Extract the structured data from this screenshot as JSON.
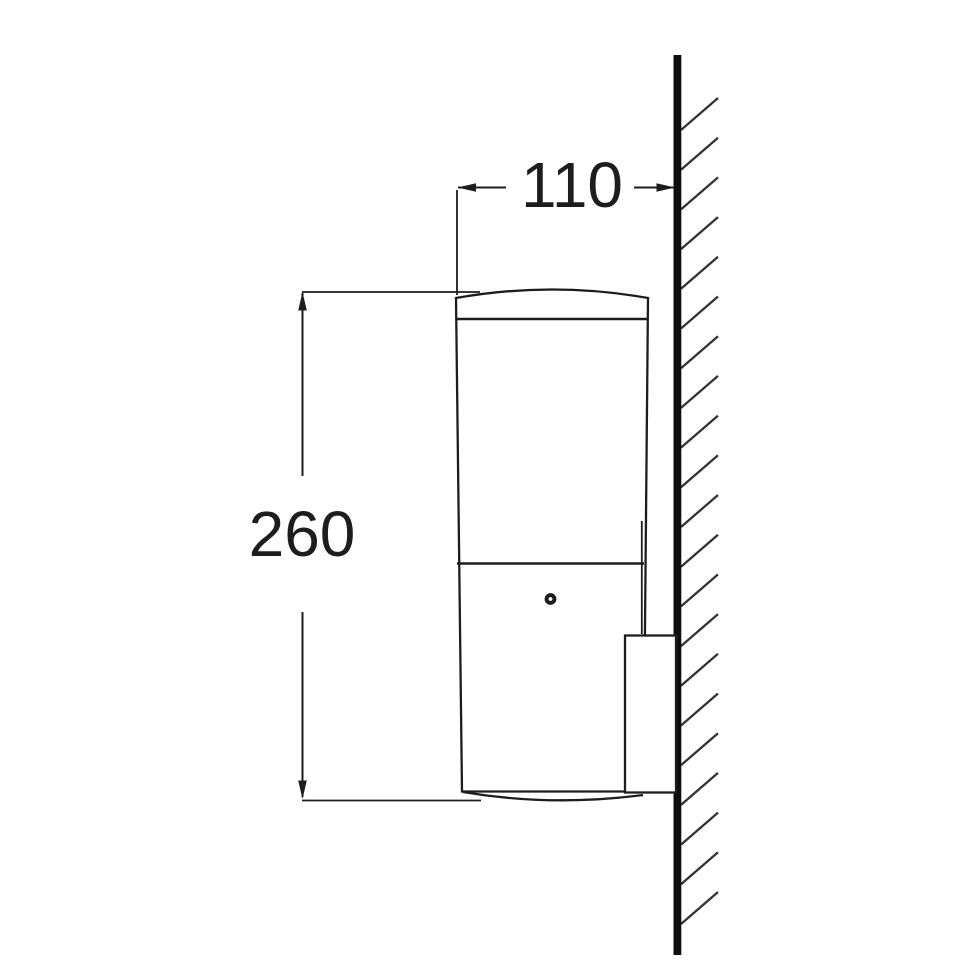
{
  "colors": {
    "background": "#ffffff",
    "ink": "#1d1d1d",
    "wall": "#0e0e0e",
    "hatch": "#333333"
  },
  "drawing": {
    "subject": "wall-luminaire-side-view",
    "dimensions": {
      "depth": {
        "label": "110"
      },
      "height": {
        "label": "260"
      }
    }
  },
  "hatch": {
    "x": 681,
    "start_y": 130,
    "spacing": 39.7,
    "count": 21,
    "dx": 37,
    "dy": -32
  }
}
